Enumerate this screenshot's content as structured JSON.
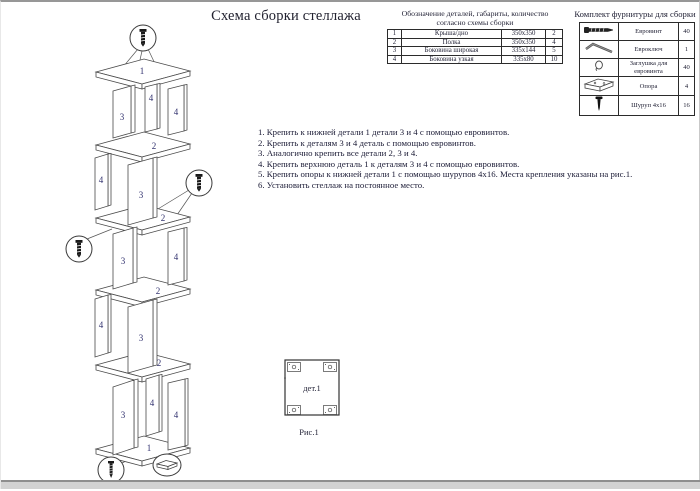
{
  "page": {
    "title": "Схема сборки стеллажа"
  },
  "parts_table": {
    "title_line1": "Обозначение деталей, габариты, количество",
    "title_line2": "согласно схемы сборки",
    "rows": [
      {
        "num": "1",
        "name": "Крыша/дно",
        "size": "350x350",
        "qty": "2"
      },
      {
        "num": "2",
        "name": "Полка",
        "size": "350x350",
        "qty": "4"
      },
      {
        "num": "3",
        "name": "Боковина широкая",
        "size": "335x144",
        "qty": "5"
      },
      {
        "num": "4",
        "name": "Боковина узкая",
        "size": "335x80",
        "qty": "10"
      }
    ]
  },
  "hardware_table": {
    "title": "Комплект фурнитуры для сборки",
    "rows": [
      {
        "icon": "euroscrew-icon",
        "name": "Евровинт",
        "qty": "40"
      },
      {
        "icon": "hexkey-icon",
        "name": "Евроключ",
        "qty": "1"
      },
      {
        "icon": "cap-icon",
        "name": "Заглушка для евровинта",
        "qty": "40"
      },
      {
        "icon": "support-icon",
        "name": "Опора",
        "qty": "4"
      },
      {
        "icon": "screw-icon",
        "name": "Шуруп 4x16",
        "qty": "16"
      }
    ]
  },
  "instructions": {
    "items": [
      "1. Крепить к нижней детали 1 детали 3 и 4 с помощью евровинтов.",
      "2. Крепить к деталям 3 и 4 деталь с помощью евровинтов.",
      "3. Аналогично крепить все детали 2, 3 и 4.",
      "4. Крепить верхнюю деталь 1 к деталям 3 и 4 с помощью евровинтов.",
      "5. Крепить опоры к нижней детали 1 с помощью шурупов 4x16. Места крепления указаны на рис.1.",
      "6. Установить стеллаж на постоянное место."
    ]
  },
  "figure": {
    "detail_label": "дет.1",
    "caption": "Рис.1"
  },
  "diagram": {
    "labels": [
      "1",
      "3",
      "4",
      "4",
      "2",
      "4",
      "3",
      "2",
      "3",
      "4",
      "2",
      "4",
      "3",
      "2",
      "3",
      "4",
      "4",
      "1"
    ]
  },
  "colors": {
    "label_accent": "#31316e",
    "line": "#3f3f3f",
    "text": "#20203a"
  }
}
